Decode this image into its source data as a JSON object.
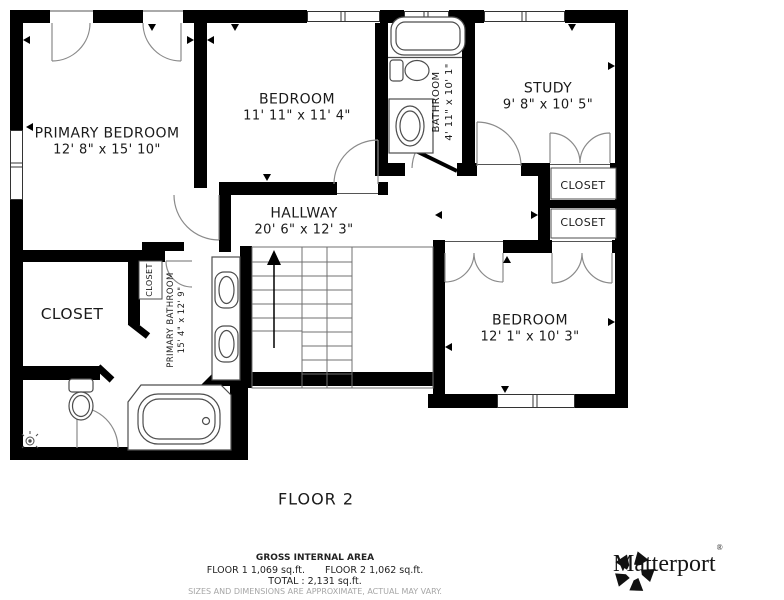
{
  "title": "FLOOR 2",
  "rooms": {
    "primary_bedroom": {
      "label": "PRIMARY BEDROOM",
      "dims": "12' 8\" x 15' 10\""
    },
    "bedroom_top": {
      "label": "BEDROOM",
      "dims": "11' 11\" x 11' 4\""
    },
    "bathroom": {
      "label": "BATHROOM",
      "dims": "4' 11\" x 10' 1\""
    },
    "study": {
      "label": "STUDY",
      "dims": "9' 8\" x 10' 5\""
    },
    "hallway": {
      "label": "HALLWAY",
      "dims": "20' 6\" x 12' 3\""
    },
    "closet_study": {
      "label": "CLOSET"
    },
    "closet_hall": {
      "label": "CLOSET"
    },
    "closet_primary": {
      "label": "CLOSET"
    },
    "closet_small": {
      "label": "CLOSET"
    },
    "primary_bathroom": {
      "label": "PRIMARY BATHROOM",
      "dims": "15' 4\" x 12' 9\""
    },
    "bedroom_bottom": {
      "label": "BEDROOM",
      "dims": "12' 1\" x 10' 3\""
    }
  },
  "footer": {
    "area_heading": "GROSS INTERNAL AREA",
    "floor1_area": "FLOOR 1 1,069 sq.ft.",
    "floor2_area": "FLOOR 2 1,062 sq.ft.",
    "total_area": "TOTAL :  2,131 sq.ft.",
    "disclaimer": "SIZES AND DIMENSIONS ARE APPROXIMATE, ACTUAL MAY VARY."
  },
  "branding": {
    "name": "Matterport",
    "registered_mark": "®",
    "logo_icon": "matterport-pinwheel-icon"
  },
  "colors": {
    "wall": "#000000",
    "fixture_line": "#4d4d4d",
    "door_arc": "#8a8a8a",
    "stair_line": "#707070",
    "text": "#1a1a1a",
    "disclaimer_text": "#a6a6a6"
  },
  "icons": [
    "bathtub-icon",
    "toilet-icon",
    "sink-icon",
    "shower-head-icon",
    "staircase-icon",
    "window-icon",
    "door-arc-icon"
  ]
}
